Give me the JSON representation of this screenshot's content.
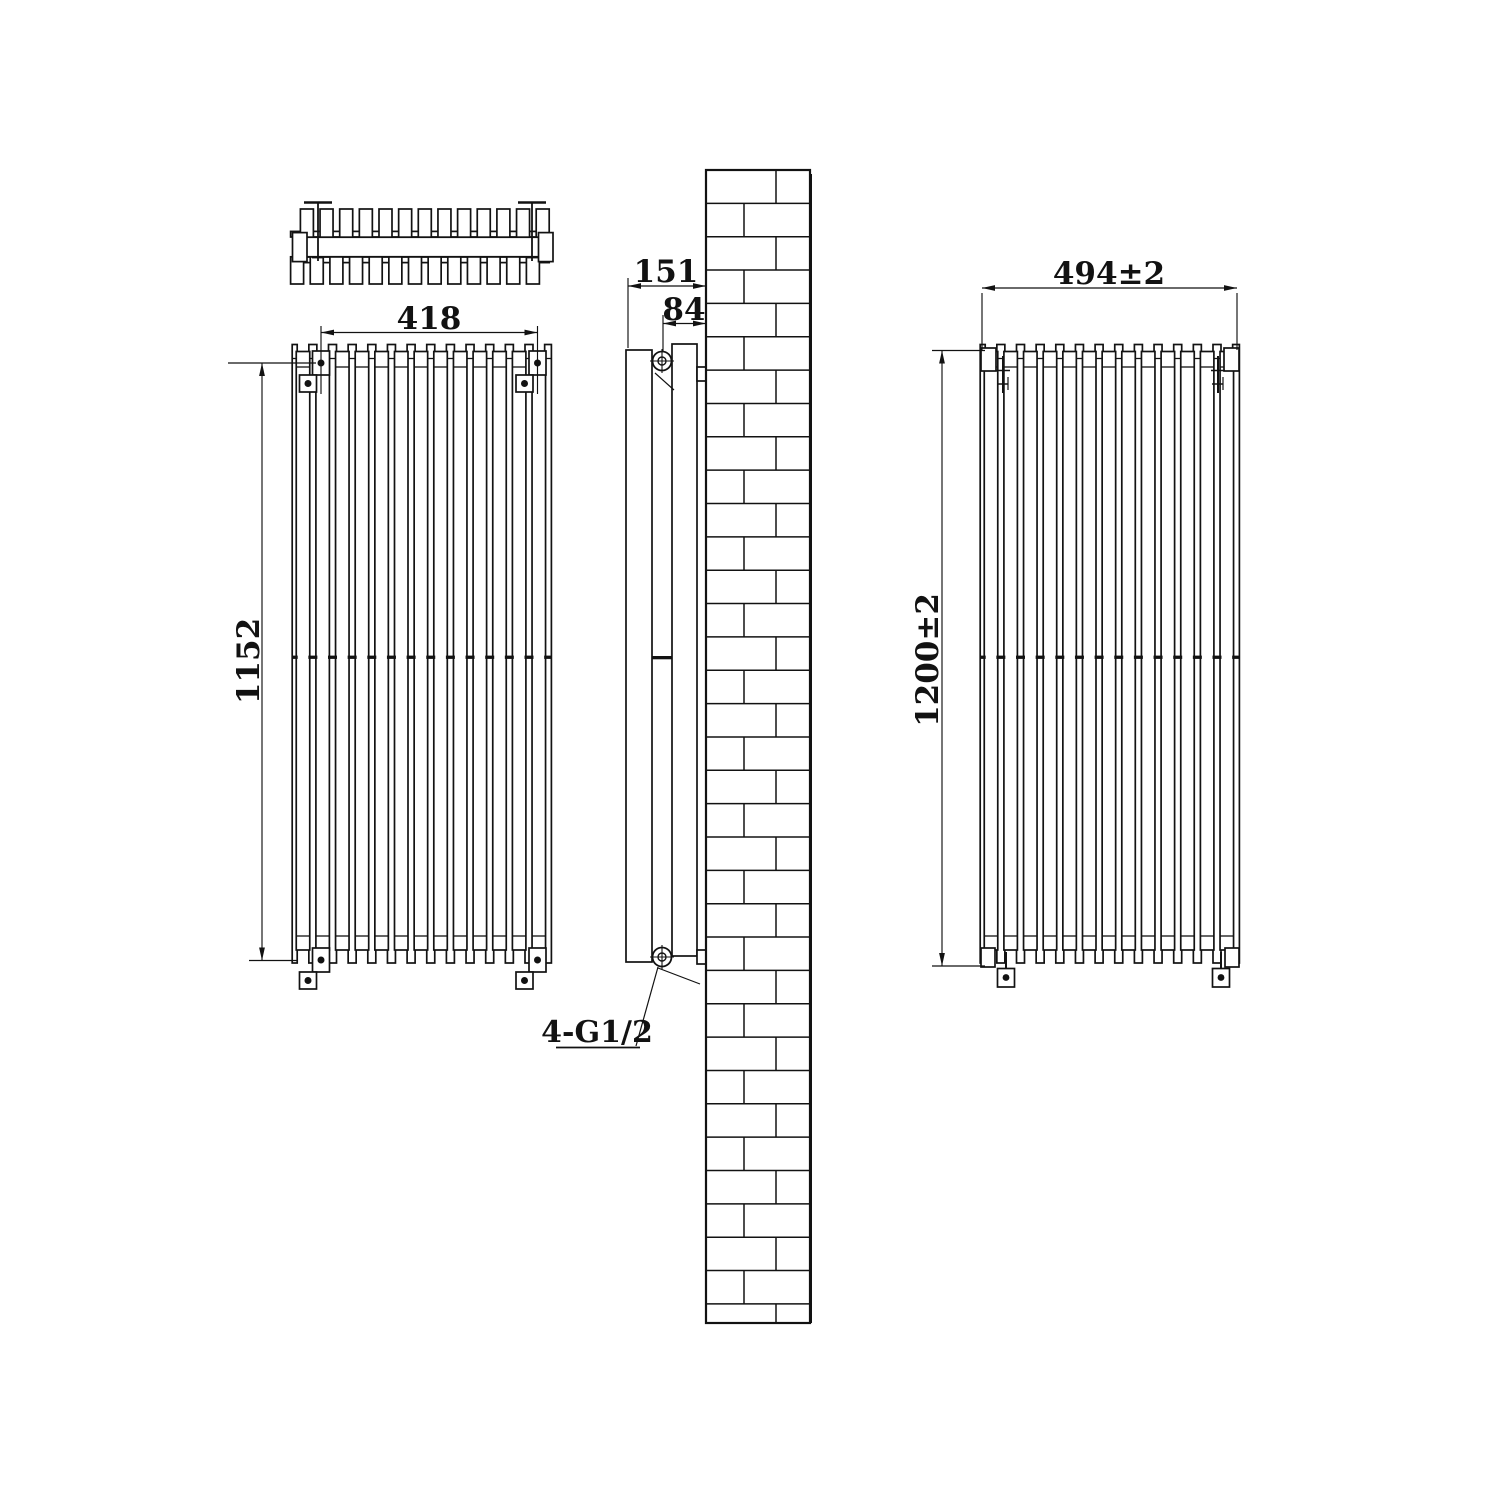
{
  "document": {
    "kind": "technical drawing",
    "subject": "vertical double-column radiator installation drawing with brick wall section",
    "views": [
      "top-view",
      "front-view",
      "side-view",
      "rear-view"
    ]
  },
  "colors": {
    "line": "#121212",
    "background": "#ffffff"
  },
  "structure": {
    "tubes_per_row": 13,
    "rows": 2,
    "wall_bracket_count": 4
  },
  "dimensions": {
    "bracket_horizontal_spacing": "418",
    "bracket_vertical_spacing": "1152",
    "overall_depth_from_wall": "151",
    "connection_to_wall_offset": "84",
    "overall_width": "494±2",
    "overall_height": "1200±2",
    "connection_thread_label": "4-G1/2"
  }
}
